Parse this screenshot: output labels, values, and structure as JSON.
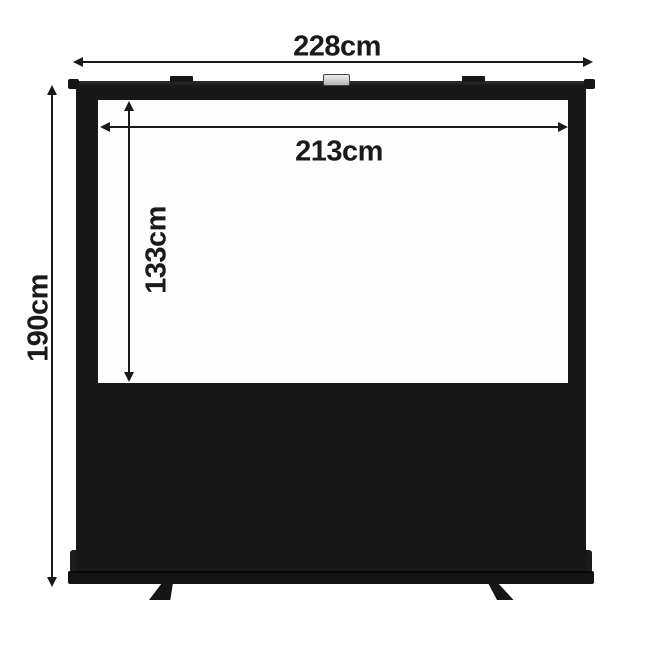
{
  "diagram": {
    "dimensions": {
      "total_width": "228cm",
      "screen_width": "213cm",
      "screen_height": "133cm",
      "total_height": "190cm"
    },
    "colors": {
      "background": "#ffffff",
      "product_body": "#181818",
      "screen_surface": "#fdfdfd",
      "dimension_lines": "#1a1a1a",
      "handle": "#d6d6d6"
    }
  }
}
